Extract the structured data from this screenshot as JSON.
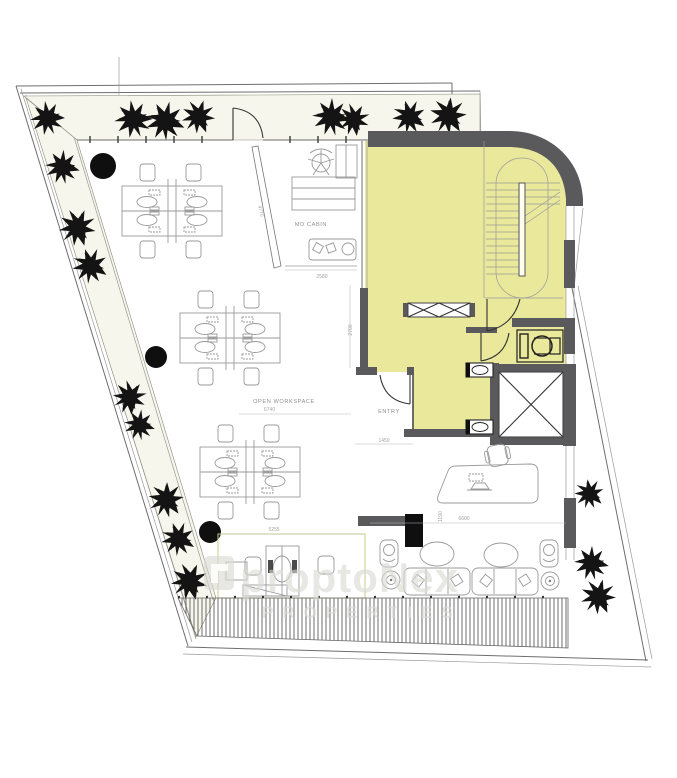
{
  "plan": {
    "type": "office-floor-plan",
    "rooms": {
      "md_cabin": "MD CABIN",
      "open_workspace": "OPEN WORKSPACE",
      "entry": "ENTRY"
    },
    "dimensions": {
      "md_cabin_width": "2580",
      "md_cabin_wall": "4770",
      "core_depth": "2700",
      "workspace_width": "6740",
      "entry_width": "1450",
      "workzone_width": "5255",
      "lounge_width": "6600",
      "lounge_depth": "1190"
    },
    "watermark": {
      "brand": "proptoNex",
      "tagline": "PROPERTIES"
    },
    "features": {
      "workstation_clusters": 3,
      "lounge_sofas": 2,
      "lounge_armchairs": 2,
      "coffee_tables": 2,
      "columns_round": 3,
      "columns_square": 1,
      "staircase": 1,
      "elevator": 1,
      "accessible_toilet": 1,
      "wash_basins": 2,
      "reception_desk": 1
    },
    "colors": {
      "highlight_yellow": "#e9e89b",
      "wall_gray": "#5a5a5c",
      "tree_black": "#141414",
      "line_gray": "#9a9a9a",
      "planter_tint": "#f6f6ec"
    }
  }
}
